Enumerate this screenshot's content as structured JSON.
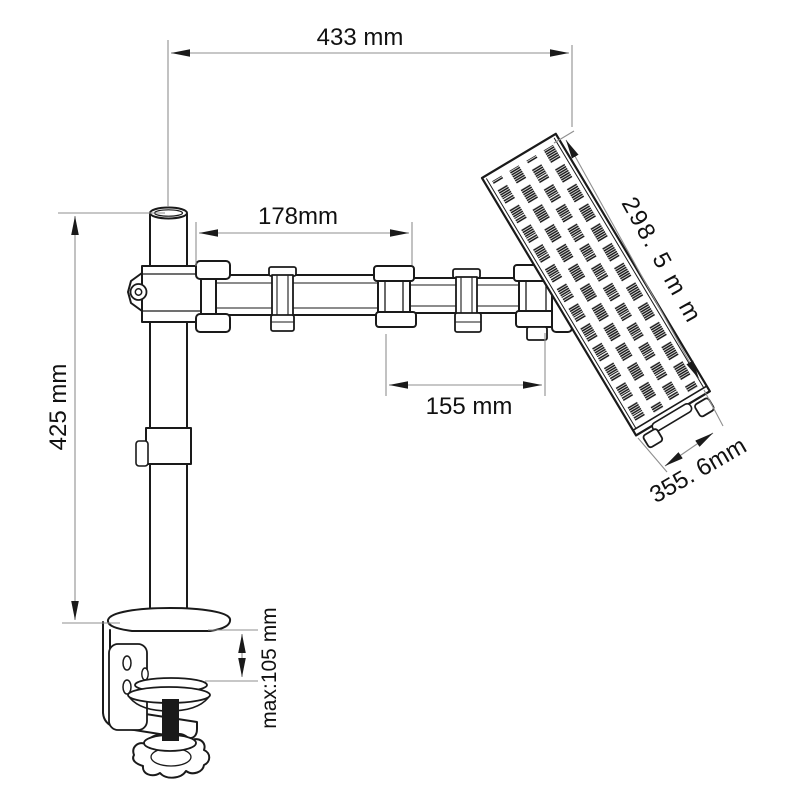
{
  "labels": {
    "overall_reach": "433 mm",
    "upper_arm": "178mm",
    "forearm": "155 mm",
    "pole_height": "425 mm",
    "clamp_max": "max:105 mm",
    "tray_length": "298. 5 m m",
    "tray_width": "355. 6mm"
  },
  "colors": {
    "outline": "#1a1a1a",
    "dimension_line": "#8f8f8f",
    "text": "#111111",
    "background": "#ffffff"
  }
}
